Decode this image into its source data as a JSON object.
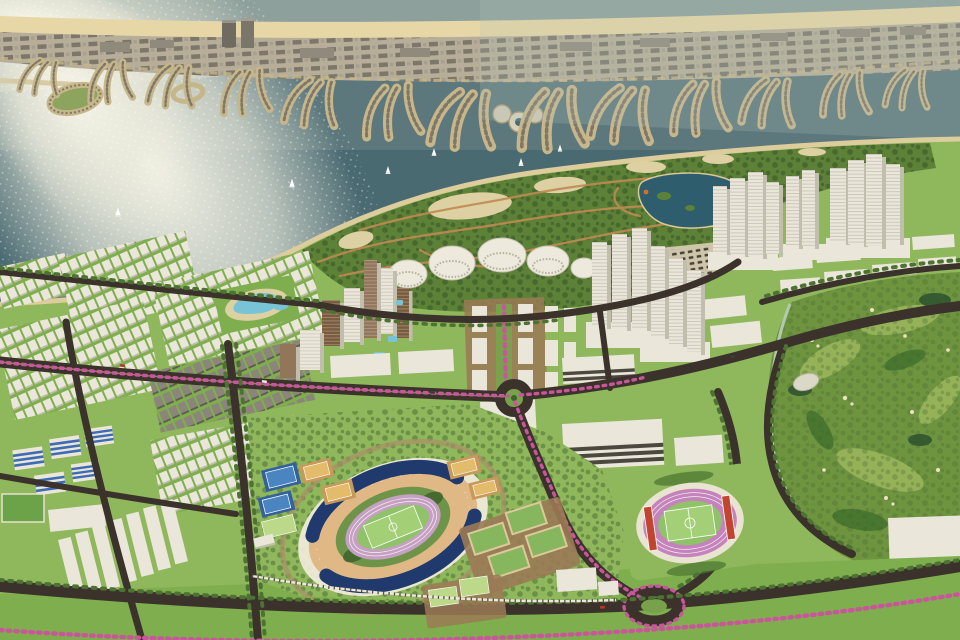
{
  "meta": {
    "kind": "aerial-3d-masterplan-render",
    "description": "Bird's-eye architectural rendering of a coastal city masterplan: palm-frond artificial island across the top water, sun glint on sea at upper left, green headland park with dome pavilions and a lake, clusters of white high-rise towers, low-rise housing grids on the left, a large navy-roofed stadium with athletics track, a small pink-track training stadium, a golf course on the right, and tree-lined roads with pink flowering medians.",
    "visible_text": "none"
  },
  "colors": {
    "water": "#4a6a72",
    "water_far": "#93a5a0",
    "haze": "#b8c2ba",
    "shore_sand": "#ddcc9c",
    "island_base": "#b7ae99",
    "island_beach": "#e7d7a6",
    "island_block": "#726d60",
    "island_block2": "#a49e8e",
    "frond_sand": "#c6b68a",
    "frond_house": "#7f7767",
    "park_green": "#5e8138",
    "park_tree": "#3f612b",
    "park_sand": "#ddd0a2",
    "path": "#c08a52",
    "lake": "#2e5d6d",
    "dome_white": "#edeadd",
    "dome_shade": "#c9c4b2",
    "bldg_white": "#eae6d9",
    "bldg_shade": "#c2beae",
    "bldg_band": "#4c4840",
    "brown_bldg": "#7a5c3c",
    "brown_bldg2": "#93765a",
    "road": "#3a322b",
    "road_light": "#ded9c6",
    "median_green": "#6d9a44",
    "pink": "#c9569b",
    "tree_row": "#4d7232",
    "lawn": "#8fb75c",
    "lawn_dark": "#7fae4e",
    "lawn_light": "#a6c878",
    "pad_tan": "#cfc5a8",
    "ground_brown": "#9b7a55",
    "car": "#45413a",
    "navy_roof": "#203a6e",
    "seat_tan": "#dfb885",
    "track_mauve": "#c5a0c2",
    "track_pink": "#c583bb",
    "pitch": "#8fc269",
    "pitch_light": "#a3d077",
    "court_blue": "#4a85c2",
    "court_blue_dark": "#33619c",
    "court_yellow": "#e2bc6a",
    "court_frame": "#c9995a",
    "court_green": "#86b75e",
    "field_lime": "#bcd98a",
    "red_stand": "#c2452f",
    "golf": "#6f9440",
    "golf_light": "#9ab65c",
    "golf_dark": "#47742f",
    "golf_teal": "#2f5430",
    "golf_sand": "#ece4c0",
    "golf_wall": "#b3c9ad",
    "pool": "#79c3d6",
    "blue_stripe": "#3d6cb4",
    "roof_green": "#6da348",
    "glint": "#f2f0e2"
  },
  "scene": {
    "sea": {
      "sun_glint": "upper-left",
      "sailboats": 6
    },
    "artificial_island": {
      "style": "palm-frond residential island with beach strip, building rows, 2 high-rise blocks, circular marina, oval lagoon ring, pier",
      "frond_clusters": 13
    },
    "park": {
      "features": [
        "dome-pavilions",
        "lake-with-islets",
        "winding-paths",
        "sand-clearings"
      ],
      "dome_pavilions": 5
    },
    "tower_groups": 4,
    "stadium": {
      "roof": "navy",
      "track": "mauve with white lanes",
      "pitch": "green",
      "seating": "tan"
    },
    "training_stadium": {
      "track": "pink",
      "stands": "red-orange"
    },
    "sports_fields": [
      "blue-tennis",
      "yellow-courts",
      "green-courts",
      "practice-pitches"
    ],
    "golf_course": {
      "position": "right",
      "features": [
        "bunkers",
        "tree-clusters",
        "boundary-road"
      ]
    },
    "housing": [
      "townhouse-grids",
      "lagoon-pool-amenity",
      "blue-striped-apartments",
      "warehouse-rows"
    ],
    "roads": {
      "roundabouts": 2,
      "medians": "pink flowering trees",
      "bottom_hedge": "pink flowering row"
    }
  }
}
